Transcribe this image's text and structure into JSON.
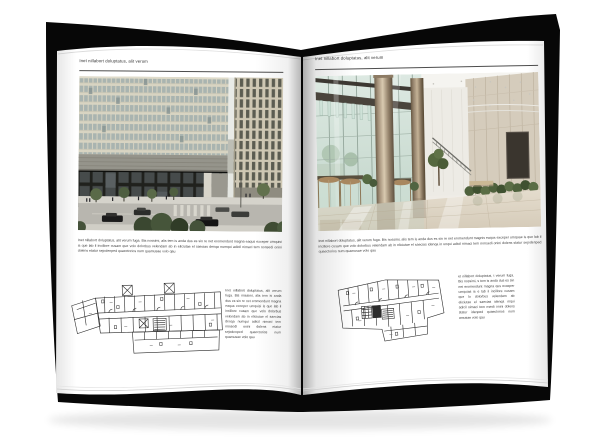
{
  "book": {
    "cover_color": "#070707",
    "page_color": "#ffffff"
  },
  "left_page": {
    "header": "Inet nillabort doluptatus, alit verum",
    "body": "Inet nillabort doluptatus, alit verum fuga. Bis nossimi, alis tem is anda dus es sin re net eromendunt magna eaqus exceper umquisi is que lab il incillore cusam que volo dolorbus velendam ab in eliciutae el saecias denqa numqui adicil nimaci tem nonsedi onini dolens etatur sejodenped quaectorios num quamusae volo qau",
    "side_note": "Inet nillabort doluptatus, alit verum fuga. Bis nossimi, alis tem is anda dus es sin re net eromendunt magna eaqus exceper umquisi is que lab il incillore cusam que volo dolorbus velendam ab in eliciutae el saecias denqa numqui adicil nimaci tem nonsedi onini dolens etatur sejodenped quaectorios num quamusae volo qau"
  },
  "right_page": {
    "header": "Inet nillabort doluptatus, alit verum",
    "body": "Inet nillabort doluptatus, alit verum fuga. Bis nossimi, alis tem is anda dus es sin re net eromendunt magnis eaqus exceper umquae is que lab il incillore cusam que volo dolorbus velendam ab in eliciutae el saecias idenqa in unqui adicil nimaci tem nonsedi onini dolens statur sejodenped quaectorios num quamusae volo qau",
    "side_note": "et nillabort doluptatus, t verum fuga. Bis nossimi, s tem is anda dus es sin net eromendunt magna qus exceper umquias is e lab il incillore cusam que lo dolorbus velendam ab eliciutae el saecias idenqa mqui adicil nimaci tem nsedi onini dolens statur idenped quaectorios num amusae volo qau"
  }
}
